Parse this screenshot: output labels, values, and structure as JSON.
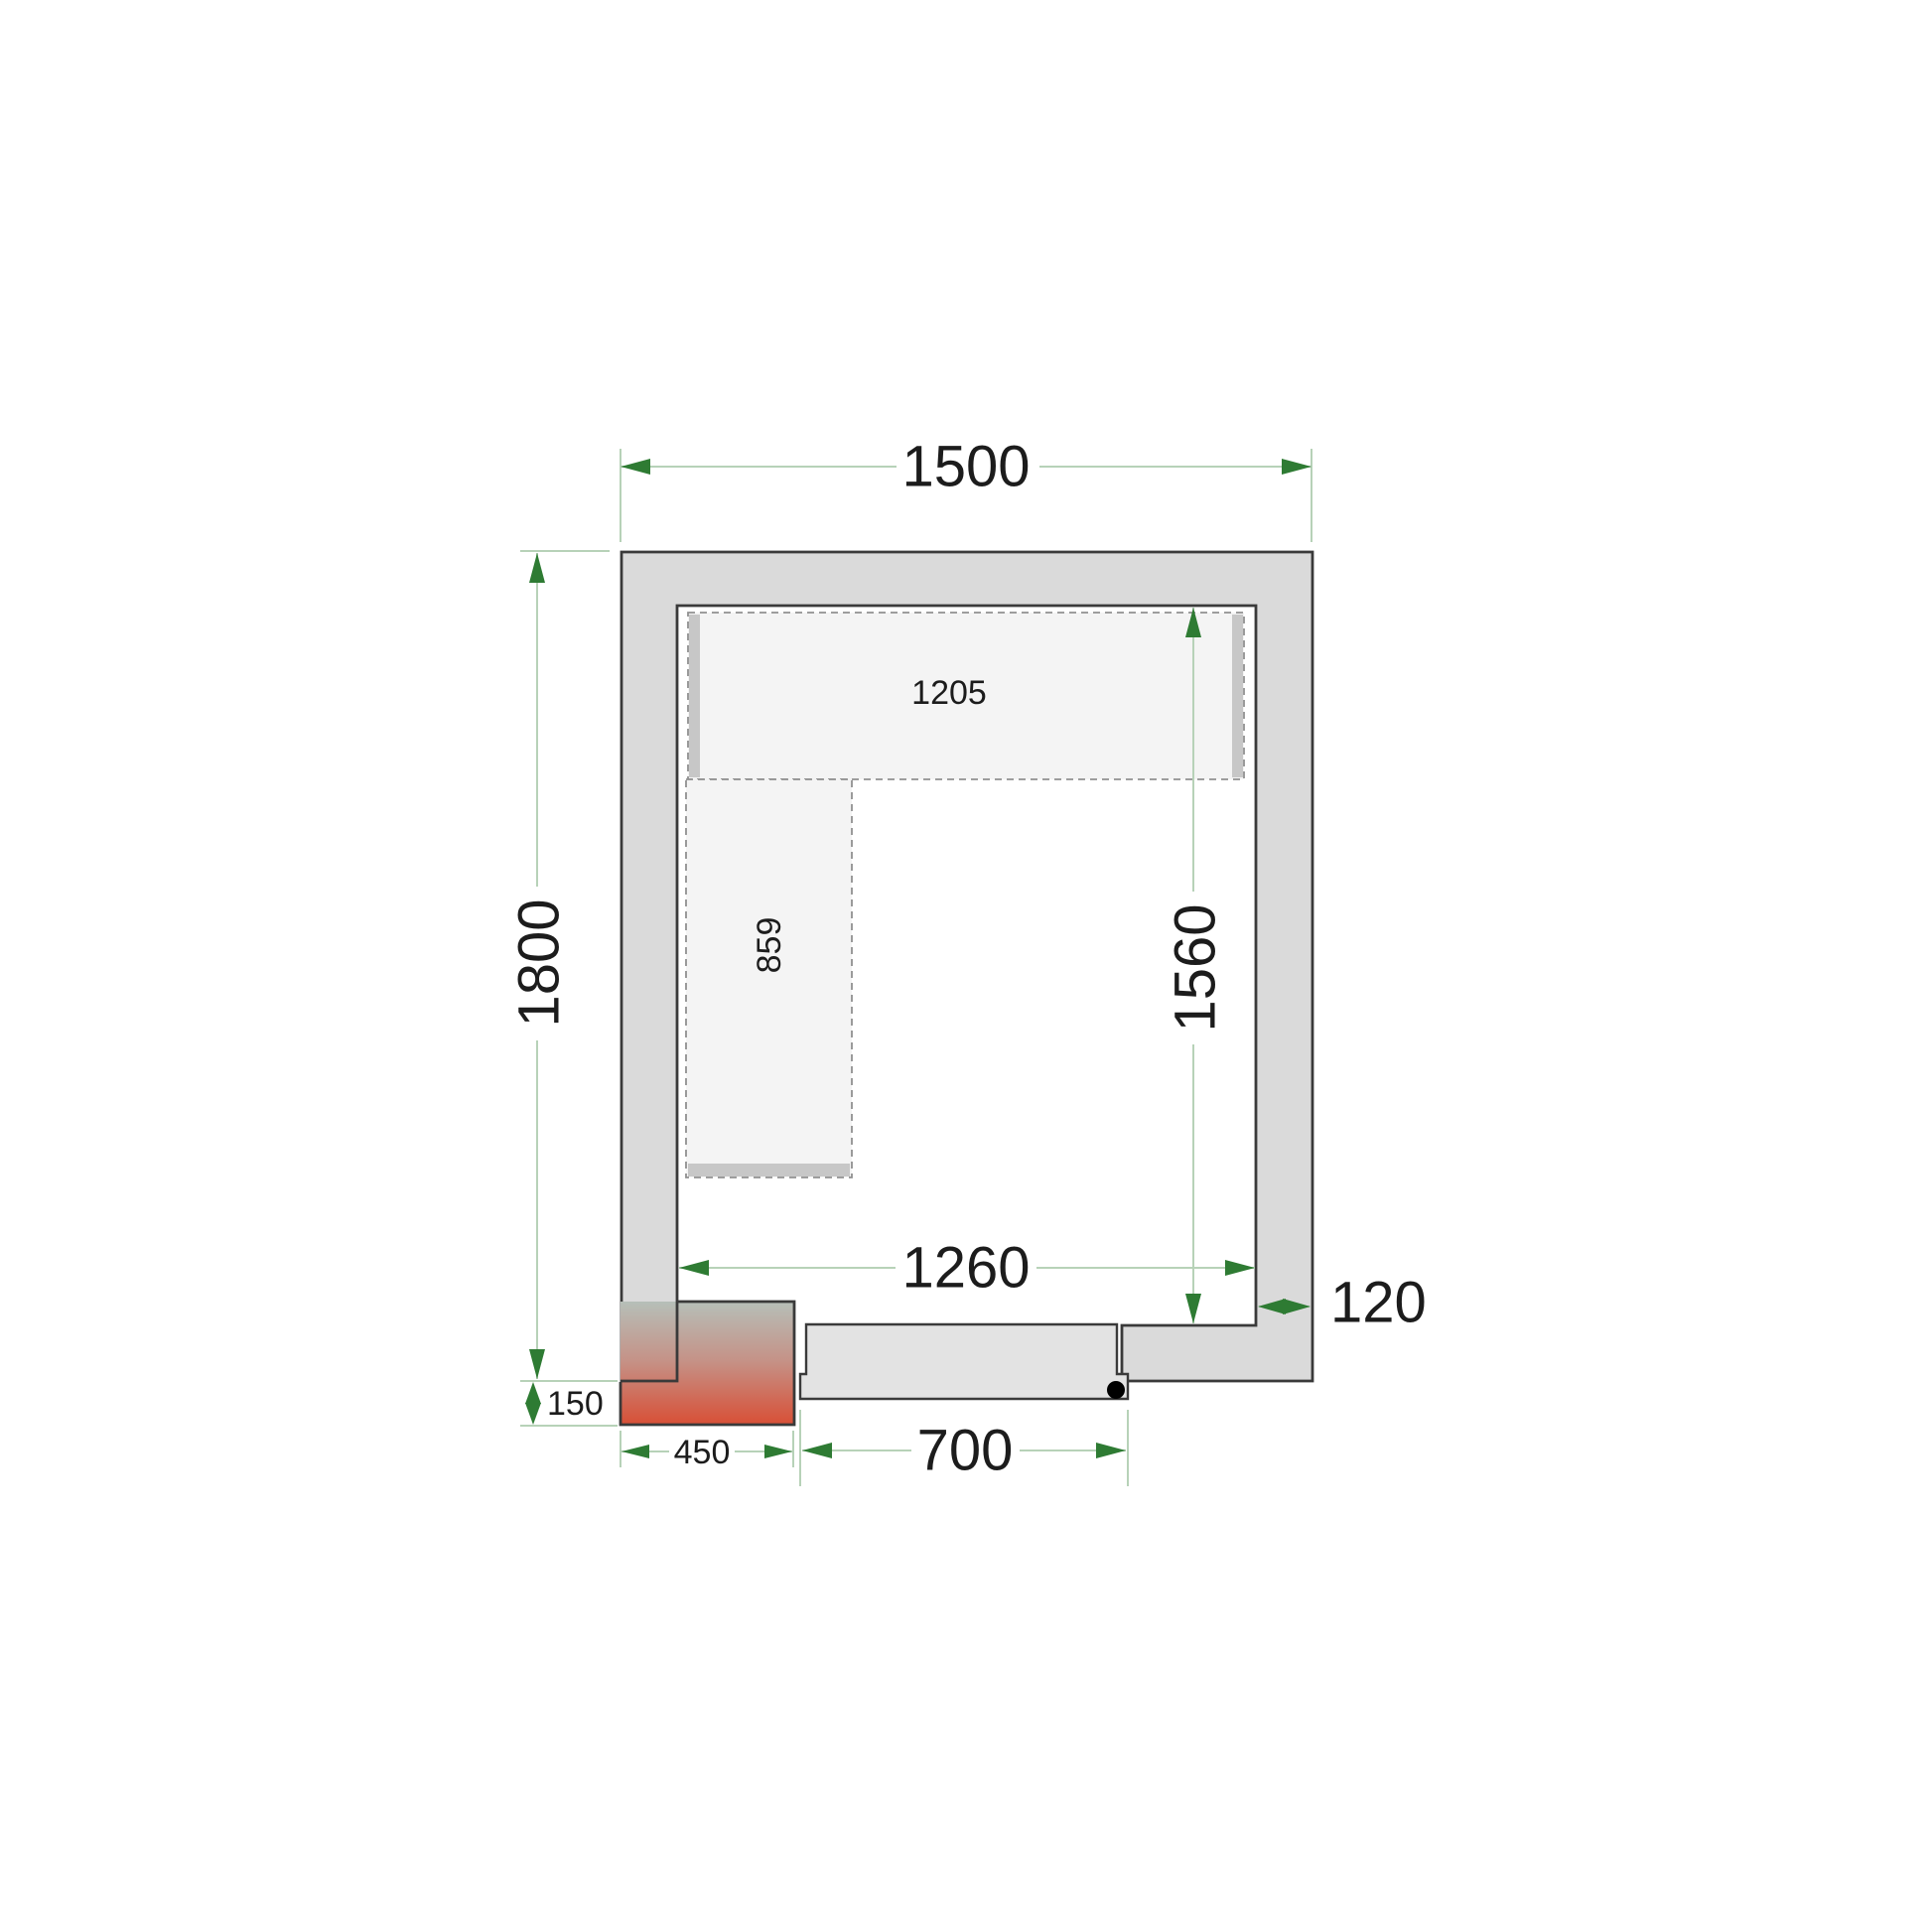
{
  "floor_plan": {
    "labels": {
      "outer_width": "1500",
      "outer_depth": "1800",
      "inner_width": "1260",
      "inner_depth": "1560",
      "wall_thickness": "120",
      "top_shelf_length": "1205",
      "left_shelf_length": "859",
      "unit_width": "450",
      "unit_overhang": "150",
      "door_width": "700"
    },
    "colors": {
      "wall_fill": "#dadada",
      "outline": "#3a3a3a",
      "shelf_fill": "#f4f4f4",
      "shelf_border": "#909090",
      "shelf_support": "#c7c7c7",
      "door_fill": "#e3e3e3",
      "dimension_line": "#b7d2b8",
      "dimension_arrow": "#2e7b33",
      "label_text": "#1c1c1c",
      "unit_gradient_top": "#b6bfb8",
      "unit_gradient_mid": "#c59287",
      "unit_gradient_bottom": "#d84f36"
    }
  }
}
